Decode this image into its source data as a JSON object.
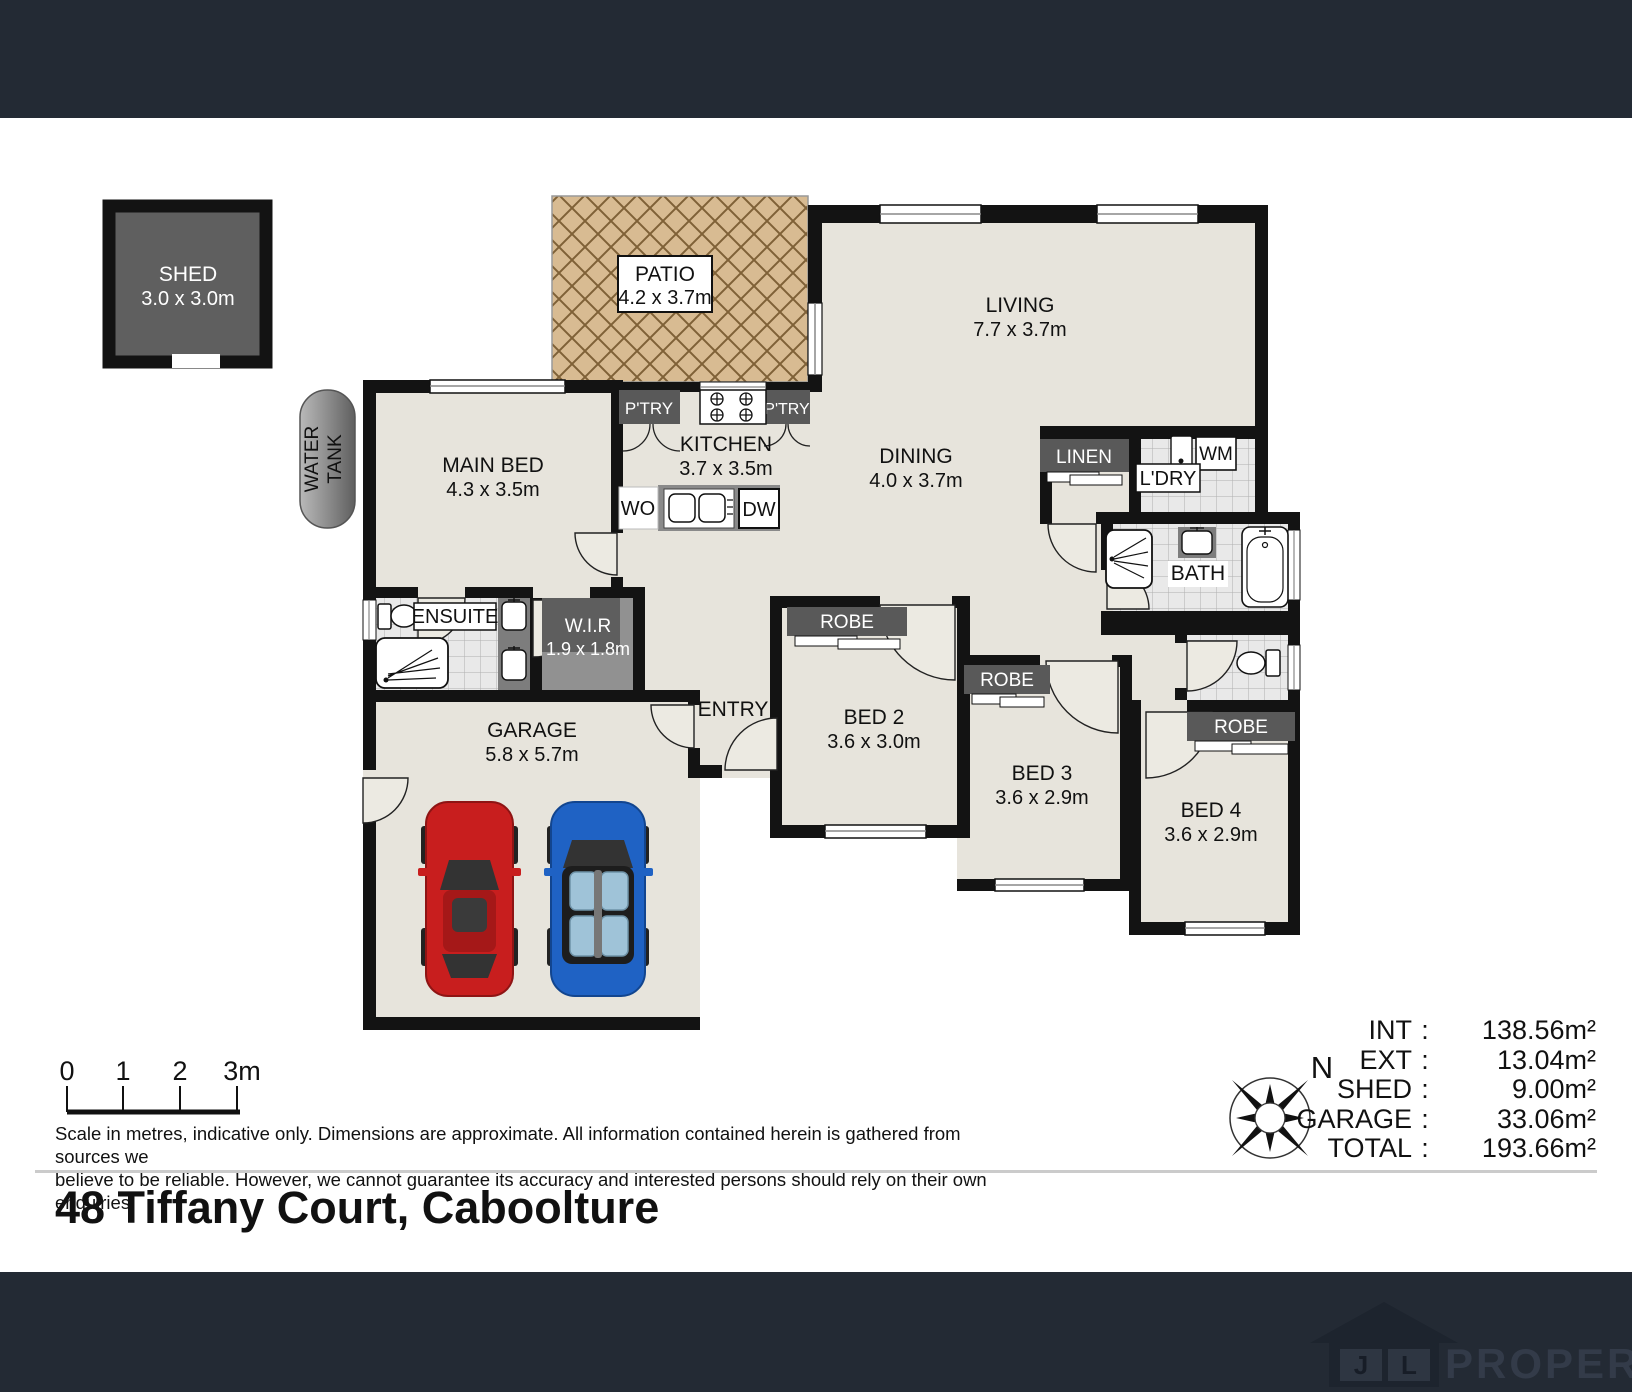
{
  "address": "48 Tiffany Court, Caboolture",
  "plan": {
    "shed": {
      "name": "SHED",
      "dims": "3.0 x 3.0m"
    },
    "patio": {
      "name": "PATIO",
      "dims": "4.2 x 3.7m"
    },
    "living": {
      "name": "LIVING",
      "dims": "7.7 x 3.7m"
    },
    "dining": {
      "name": "DINING",
      "dims": "4.0 x 3.7m"
    },
    "kitchen": {
      "name": "KITCHEN",
      "dims": "3.7 x 3.5m"
    },
    "main_bed": {
      "name": "MAIN BED",
      "dims": "4.3 x 3.5m"
    },
    "wir": {
      "name": "W.I.R",
      "dims": "1.9 x 1.8m"
    },
    "garage": {
      "name": "GARAGE",
      "dims": "5.8 x 5.7m"
    },
    "bed2": {
      "name": "BED 2",
      "dims": "3.6 x 3.0m"
    },
    "bed3": {
      "name": "BED 3",
      "dims": "3.6 x 2.9m"
    },
    "bed4": {
      "name": "BED 4",
      "dims": "3.6 x 2.9m"
    },
    "ensuite": "ENSUITE",
    "entry": "ENTRY",
    "bath": "BATH",
    "linen": "LINEN",
    "ldry": "L'DRY",
    "wm": "WM",
    "wo": "WO",
    "dw": "DW",
    "ptry": "P'TRY",
    "robe": "ROBE",
    "water_tank": {
      "line1": "WATER",
      "line2": "TANK"
    }
  },
  "scale_bar": {
    "ticks": [
      "0",
      "1",
      "2",
      "3m"
    ]
  },
  "compass": {
    "north": "N"
  },
  "disclaimer": {
    "line1": "Scale in metres, indicative only. Dimensions are approximate. All information contained herein is gathered from sources we",
    "line2": "believe to be reliable. However, we cannot guarantee its accuracy and interested persons should rely on their own enquiries."
  },
  "stats": {
    "rows": [
      {
        "label": "INT",
        "sep": ":",
        "value": "138.56m²"
      },
      {
        "label": "EXT",
        "sep": ":",
        "value": "13.04m²"
      },
      {
        "label": "SHED",
        "sep": ":",
        "value": "9.00m²"
      },
      {
        "label": "GARAGE",
        "sep": ":",
        "value": "33.06m²"
      },
      {
        "label": "TOTAL",
        "sep": ":",
        "value": "193.66m²"
      }
    ]
  },
  "footer": {
    "logo_letter_j": "J",
    "logo_letter_l": "L",
    "logo_text": "PROPERTY"
  },
  "colors": {
    "brand_bar": "#232a34",
    "floor": "#e7e4dc",
    "wall": "#131313",
    "dark_box": "#595959",
    "patio": "#d8bb92",
    "car_red": "#c81e1e",
    "car_blue": "#1f62c4"
  }
}
